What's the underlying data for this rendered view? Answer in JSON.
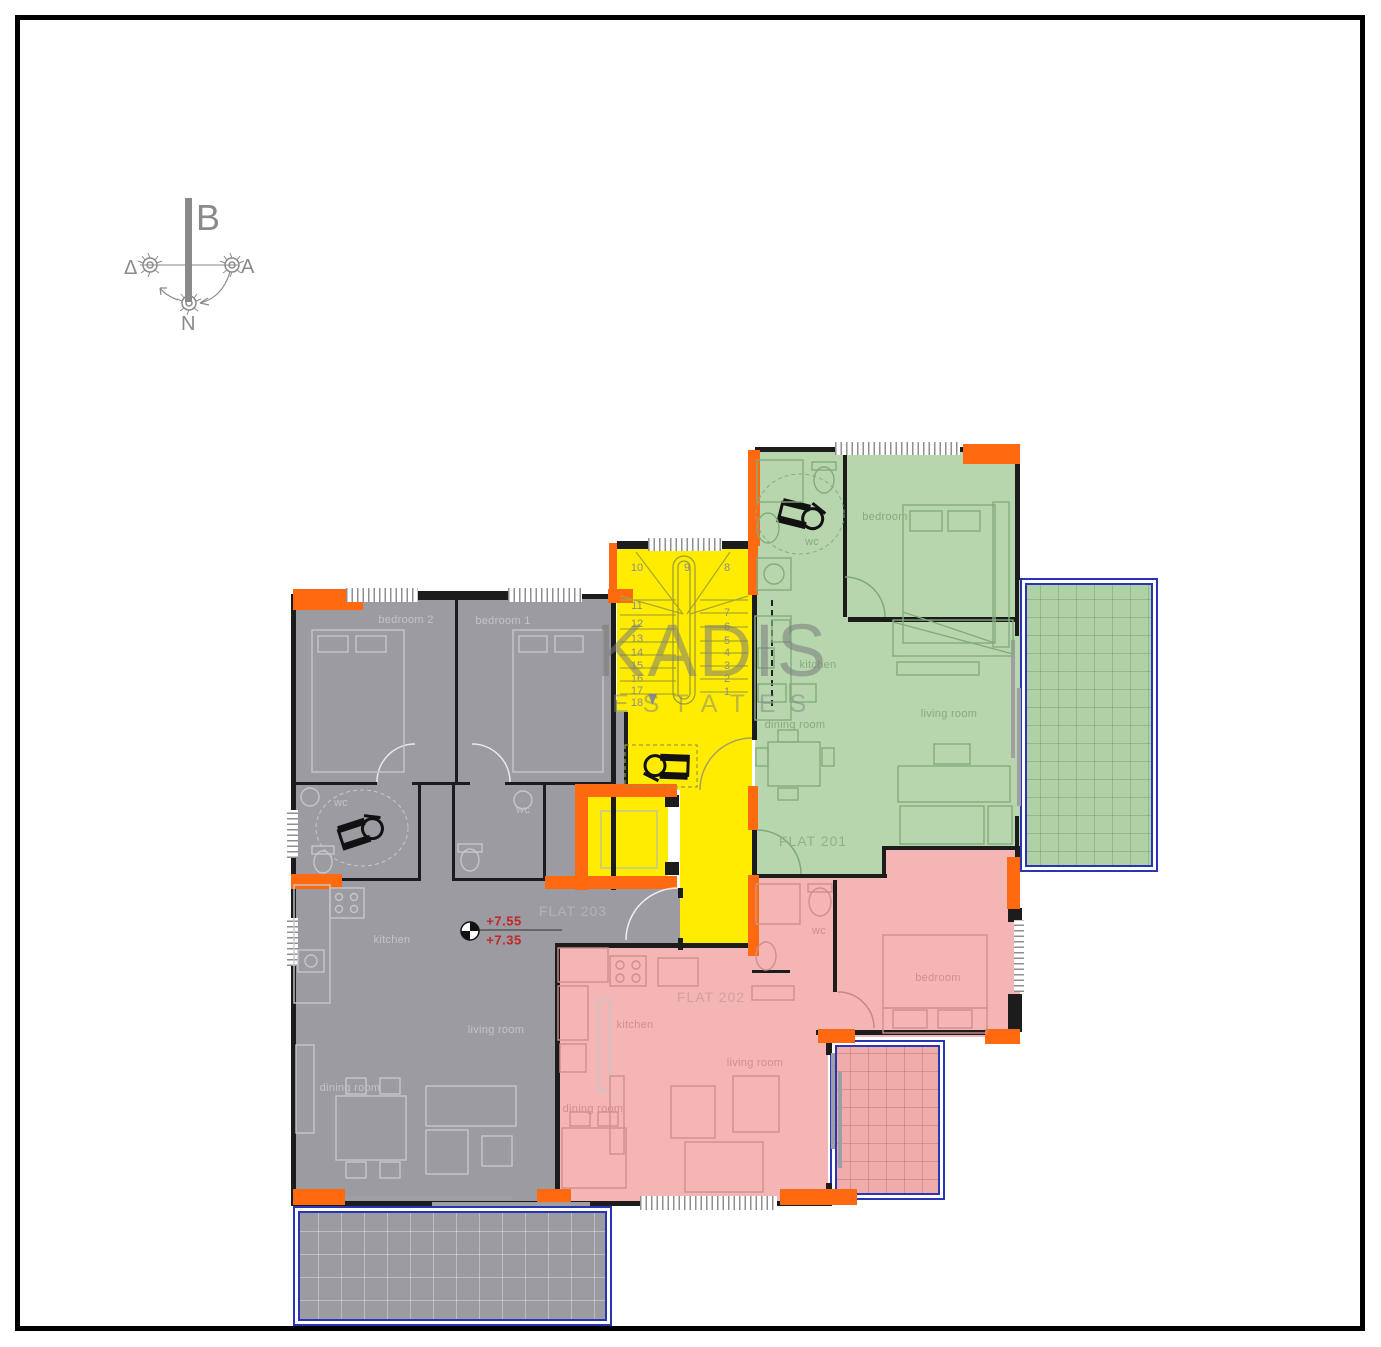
{
  "compass": {
    "top": "B",
    "left": "Δ",
    "right": "A",
    "bottom": "N"
  },
  "watermark": {
    "primary": "KADIS",
    "secondary": "ESTATES"
  },
  "levels": {
    "upper": "+7.55",
    "lower": "+7.35"
  },
  "flats": {
    "flat201": {
      "label": "FLAT 201",
      "rooms": {
        "bedroom": "bedroom",
        "kitchen": "kitchen",
        "dining": "dining room",
        "living": "living room",
        "wc": "wc"
      }
    },
    "flat202": {
      "label": "FLAT 202",
      "rooms": {
        "bedroom": "bedroom",
        "kitchen": "kitchen",
        "dining": "dining room",
        "living": "living room",
        "wc": "wc"
      }
    },
    "flat203": {
      "label": "FLAT 203",
      "rooms": {
        "bedroom1": "bedroom 1",
        "bedroom2": "bedroom 2",
        "kitchen": "kitchen",
        "dining": "dining room",
        "living": "living room",
        "wc1": "wc",
        "wc2": "wc"
      }
    }
  },
  "staircase": {
    "center": "9",
    "left": [
      "10",
      "11",
      "12",
      "13",
      "14",
      "15",
      "16",
      "17",
      "18"
    ],
    "right": [
      "8",
      "7",
      "6",
      "5",
      "4",
      "3",
      "2",
      "1"
    ]
  },
  "colors": {
    "flat_201_green": "#b7d6ae",
    "flat_202_pink": "#f4b5b5",
    "flat_203_gray": "#9b9ba1",
    "staircase_yellow": "#ffec00",
    "columns_orange": "#ff6a10",
    "balcony_border_blue": "#2a35b5",
    "level_marker_red": "#c22626",
    "walls_black": "#1c1c1c"
  }
}
